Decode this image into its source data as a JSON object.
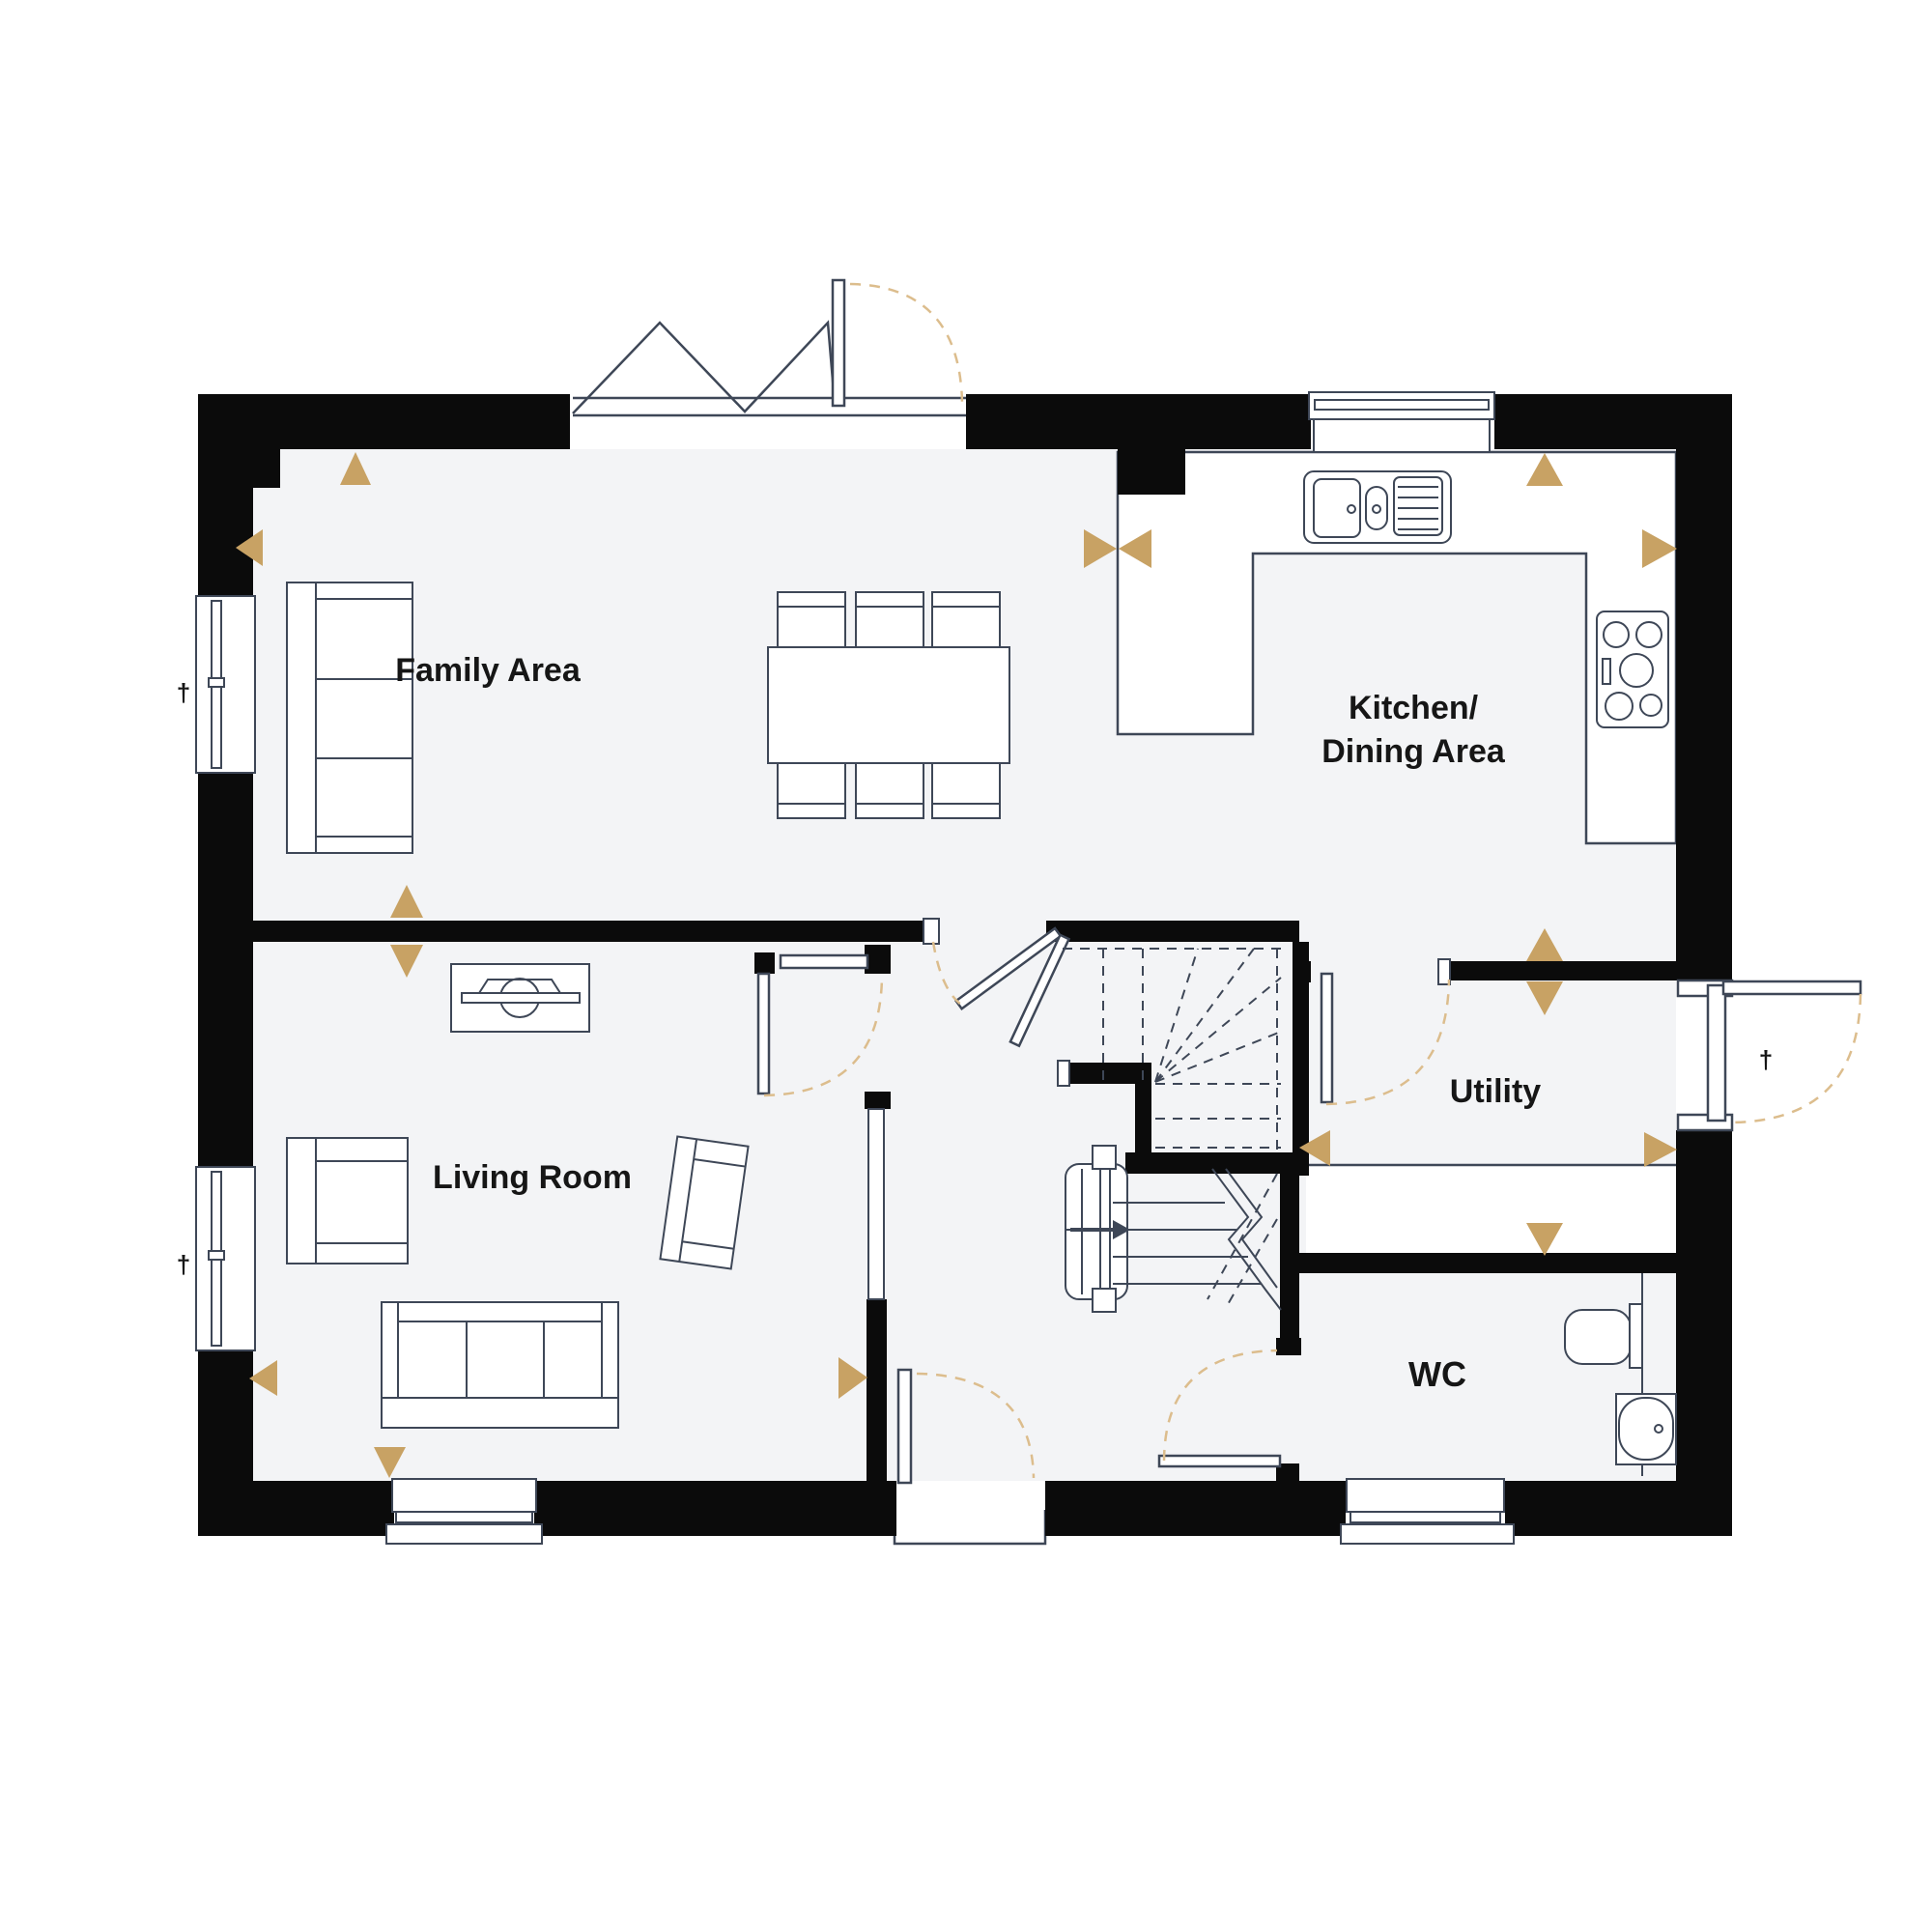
{
  "rooms": {
    "family": {
      "label": "Family Area"
    },
    "kitchen_dining": {
      "line1": "Kitchen/",
      "line2": "Dining Area"
    },
    "living": {
      "label": "Living Room"
    },
    "utility": {
      "label": "Utility"
    },
    "wc": {
      "label": "WC"
    }
  },
  "marks": {
    "window_tick": "†"
  },
  "colors": {
    "wall": "#0b0b0b",
    "floor": "#f3f4f6",
    "outline": "#3e4757",
    "tan": "#c8a264",
    "arc": "#dcbd8d",
    "label": "#161616",
    "white": "#ffffff"
  },
  "symbols": {
    "sofa": "sofa-icon",
    "armchair": "armchair-icon",
    "dining_table": "dining-table-icon",
    "dining_chair": "dining-chair-icon",
    "tv_unit": "tv-unit-icon",
    "sink": "kitchen-sink-icon",
    "hob": "hob-icon",
    "toilet": "toilet-icon",
    "basin": "basin-icon",
    "stairs": "stairs-icon",
    "radiator": "radiator-icon",
    "direction_marker": "triangle-marker-icon"
  }
}
